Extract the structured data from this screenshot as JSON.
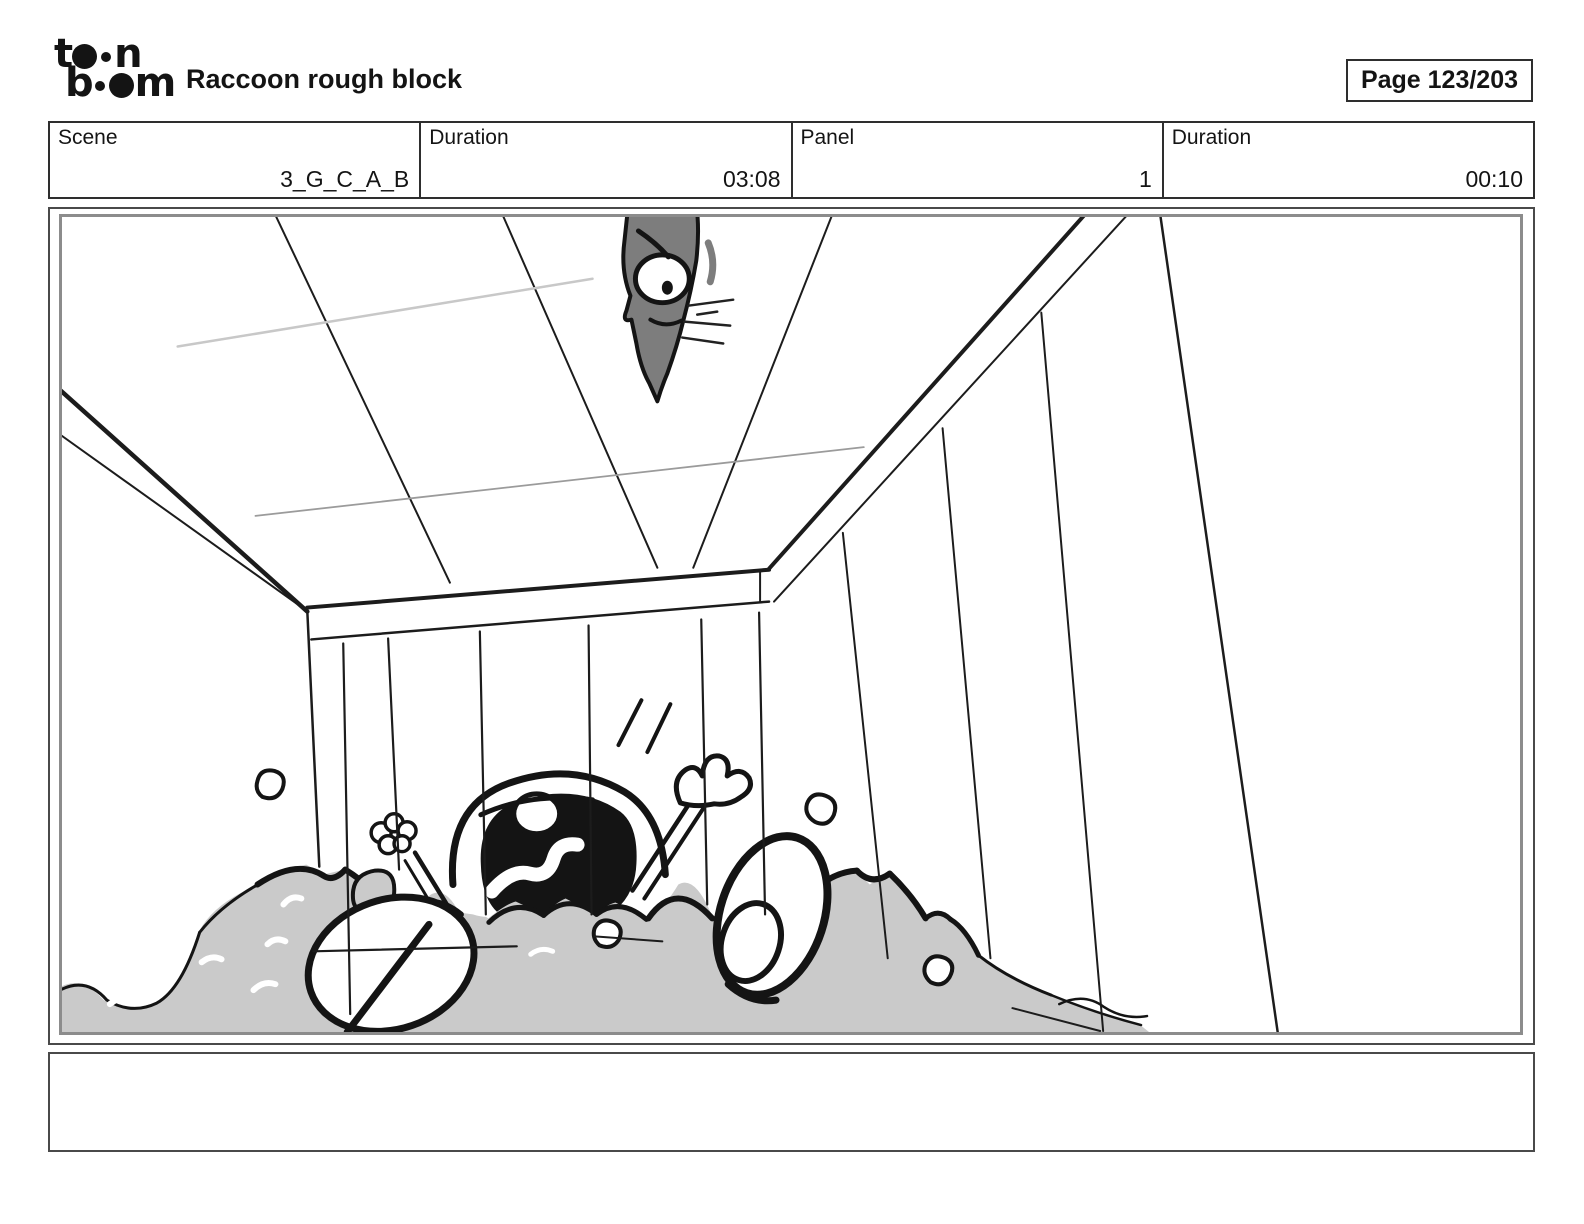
{
  "header": {
    "logo": {
      "l1a": "t",
      "l1b": "n",
      "l2a": "b",
      "l2b": "m"
    },
    "title": "Raccoon rough block",
    "page_indicator": "Page 123/203"
  },
  "info_table": {
    "cells": [
      {
        "label": "Scene",
        "value": "3_G_C_A_B"
      },
      {
        "label": "Duration",
        "value": "03:08"
      },
      {
        "label": "Panel",
        "value": "1"
      },
      {
        "label": "Duration",
        "value": "00:10"
      }
    ]
  },
  "panel": {
    "caption": ""
  },
  "colors": {
    "fluff_gray": "#cacaca",
    "figure_gray": "#7d7d7d"
  }
}
